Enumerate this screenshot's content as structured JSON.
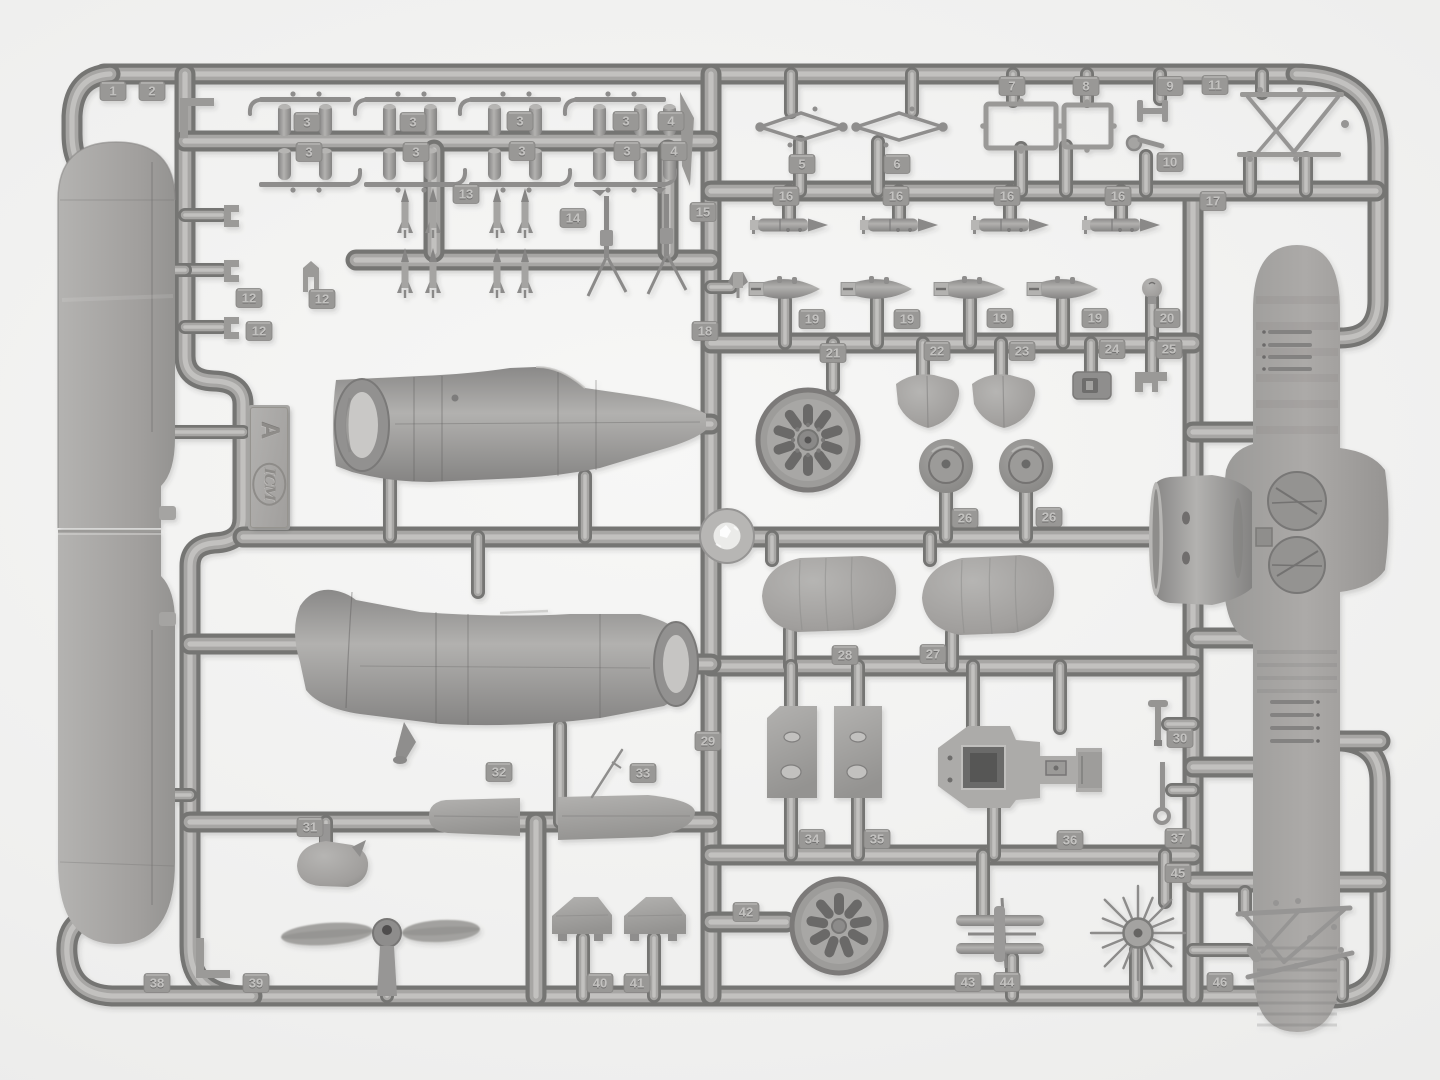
{
  "photo": {
    "description": "Top-down photograph of a gray plastic injection-molded model aircraft sprue (runner frame A) on a white background, containing biplane parts: wings, fuselage halves, cowling, engine discs, propeller, wheels, bombs, rockets, exhausts and strut frames, each with embossed number tags 1-46.",
    "background": "#f2f2f1",
    "plastic": "#9c9b99",
    "plastic_dark": "#757474",
    "plastic_light": "#c6c5c3"
  },
  "sprue": {
    "brand": "ICM",
    "letter": "A"
  },
  "part_labels": [
    {
      "n": "1",
      "x": 113,
      "y": 91
    },
    {
      "n": "2",
      "x": 152,
      "y": 91
    },
    {
      "n": "3",
      "x": 307,
      "y": 122
    },
    {
      "n": "3",
      "x": 309,
      "y": 152
    },
    {
      "n": "3",
      "x": 413,
      "y": 122
    },
    {
      "n": "3",
      "x": 416,
      "y": 152
    },
    {
      "n": "3",
      "x": 520,
      "y": 121
    },
    {
      "n": "3",
      "x": 522,
      "y": 151
    },
    {
      "n": "3",
      "x": 626,
      "y": 121
    },
    {
      "n": "3",
      "x": 627,
      "y": 151
    },
    {
      "n": "4",
      "x": 671,
      "y": 121
    },
    {
      "n": "4",
      "x": 674,
      "y": 151
    },
    {
      "n": "12",
      "x": 249,
      "y": 298
    },
    {
      "n": "12",
      "x": 322,
      "y": 299
    },
    {
      "n": "12",
      "x": 259,
      "y": 331
    },
    {
      "n": "13",
      "x": 466,
      "y": 194
    },
    {
      "n": "14",
      "x": 573,
      "y": 218
    },
    {
      "n": "15",
      "x": 703,
      "y": 212
    },
    {
      "n": "5",
      "x": 802,
      "y": 164
    },
    {
      "n": "6",
      "x": 897,
      "y": 164
    },
    {
      "n": "7",
      "x": 1012,
      "y": 86
    },
    {
      "n": "8",
      "x": 1086,
      "y": 86
    },
    {
      "n": "9",
      "x": 1170,
      "y": 86
    },
    {
      "n": "11",
      "x": 1215,
      "y": 85
    },
    {
      "n": "10",
      "x": 1170,
      "y": 162
    },
    {
      "n": "17",
      "x": 1213,
      "y": 201
    },
    {
      "n": "16",
      "x": 786,
      "y": 196
    },
    {
      "n": "16",
      "x": 896,
      "y": 196
    },
    {
      "n": "16",
      "x": 1007,
      "y": 196
    },
    {
      "n": "16",
      "x": 1118,
      "y": 196
    },
    {
      "n": "18",
      "x": 705,
      "y": 331
    },
    {
      "n": "19",
      "x": 812,
      "y": 319
    },
    {
      "n": "19",
      "x": 907,
      "y": 319
    },
    {
      "n": "19",
      "x": 1000,
      "y": 318
    },
    {
      "n": "19",
      "x": 1095,
      "y": 318
    },
    {
      "n": "20",
      "x": 1167,
      "y": 318
    },
    {
      "n": "21",
      "x": 833,
      "y": 353
    },
    {
      "n": "22",
      "x": 937,
      "y": 351
    },
    {
      "n": "23",
      "x": 1022,
      "y": 351
    },
    {
      "n": "24",
      "x": 1112,
      "y": 349
    },
    {
      "n": "25",
      "x": 1169,
      "y": 349
    },
    {
      "n": "26",
      "x": 965,
      "y": 518
    },
    {
      "n": "26",
      "x": 1049,
      "y": 517
    },
    {
      "n": "28",
      "x": 845,
      "y": 655
    },
    {
      "n": "27",
      "x": 933,
      "y": 654
    },
    {
      "n": "29",
      "x": 708,
      "y": 741
    },
    {
      "n": "30",
      "x": 1180,
      "y": 738
    },
    {
      "n": "31",
      "x": 310,
      "y": 827
    },
    {
      "n": "32",
      "x": 499,
      "y": 772
    },
    {
      "n": "33",
      "x": 643,
      "y": 773
    },
    {
      "n": "34",
      "x": 812,
      "y": 839
    },
    {
      "n": "35",
      "x": 877,
      "y": 839
    },
    {
      "n": "36",
      "x": 1070,
      "y": 840
    },
    {
      "n": "37",
      "x": 1178,
      "y": 838
    },
    {
      "n": "45",
      "x": 1178,
      "y": 873
    },
    {
      "n": "38",
      "x": 157,
      "y": 983
    },
    {
      "n": "39",
      "x": 256,
      "y": 983
    },
    {
      "n": "40",
      "x": 600,
      "y": 983
    },
    {
      "n": "41",
      "x": 637,
      "y": 983
    },
    {
      "n": "42",
      "x": 746,
      "y": 912
    },
    {
      "n": "43",
      "x": 968,
      "y": 982
    },
    {
      "n": "44",
      "x": 1007,
      "y": 982
    },
    {
      "n": "46",
      "x": 1220,
      "y": 982
    }
  ],
  "repeated_parts": {
    "exhaust_group_centers": [
      305,
      410,
      515,
      620
    ],
    "exhaust_single_x": 663,
    "small_rocket_xs": [
      405,
      433,
      497,
      525
    ],
    "small_rocket_rows": [
      188,
      248
    ],
    "rs_rocket_x0s": [
      750,
      860,
      971,
      1082
    ],
    "rs_rocket_y": 225,
    "bomb_x0s": [
      749,
      841,
      934,
      1027
    ],
    "bomb_y": 289,
    "wheel_centers": [
      [
        946,
        466
      ],
      [
        1026,
        466
      ]
    ],
    "wheel_radius": 27,
    "disc21": {
      "cx": 808,
      "cy": 440,
      "r": 50,
      "slots": 10
    },
    "disc42": {
      "cx": 839,
      "cy": 926,
      "r": 47,
      "slots": 9
    },
    "star45": {
      "cx": 1138,
      "cy": 933,
      "spokes": 16
    }
  }
}
